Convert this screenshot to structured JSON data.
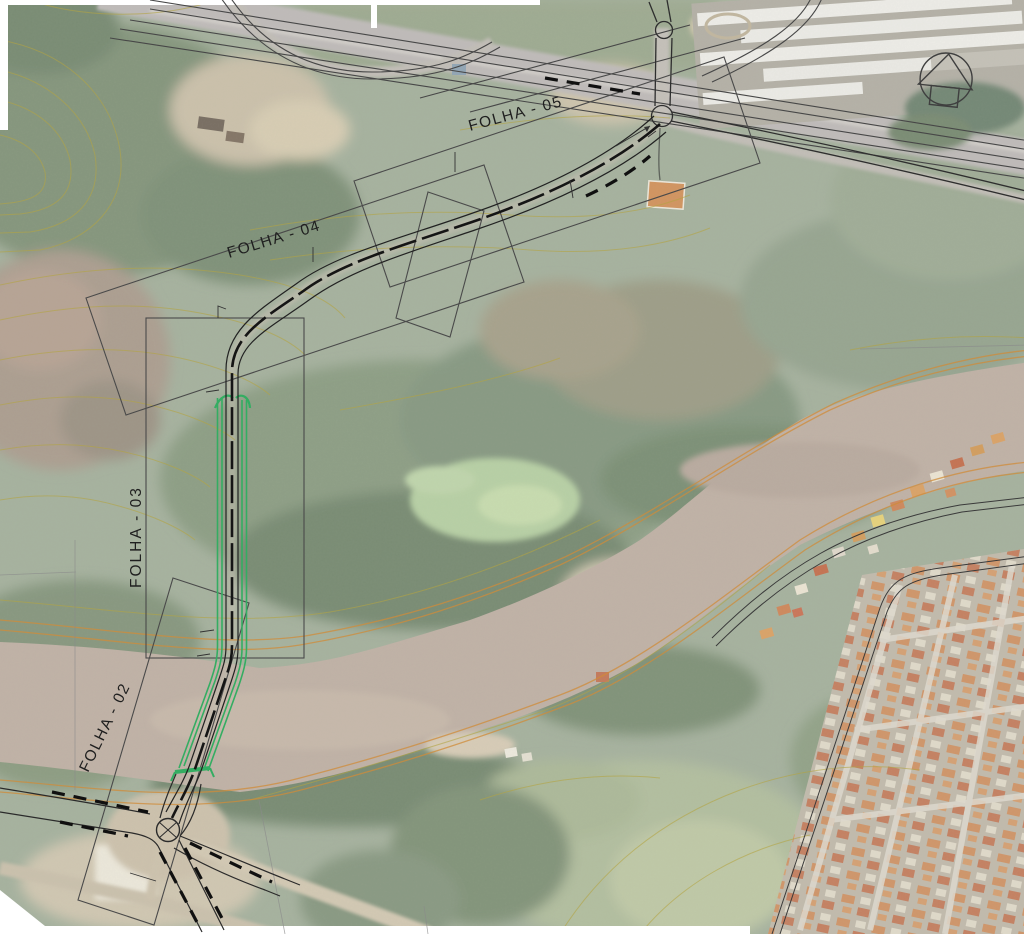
{
  "page": {
    "type": "road-design-plan-over-aerial-photo",
    "background": "#ffffff"
  },
  "sheet_labels": {
    "folha02": "FOLHA - 02",
    "folha03": "FOLHA - 03",
    "folha04": "FOLHA - 04",
    "folha05": "FOLHA - 05"
  },
  "icons": {
    "north_arrow": "north-arrow-icon"
  },
  "colors": {
    "road_edge_green": "#34ad62",
    "cad_line": "#3a3a3a",
    "contour_minor": "#b3a443",
    "contour_index": "#cf8c3a",
    "river": "#b3a294",
    "label_text": "#1f1f1f"
  }
}
